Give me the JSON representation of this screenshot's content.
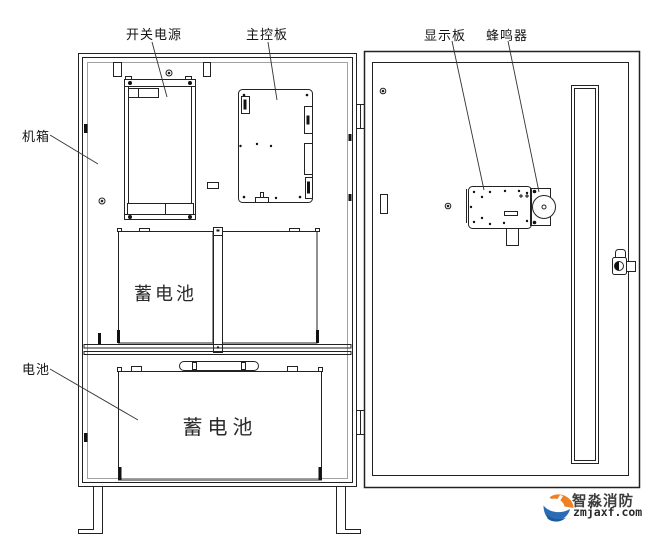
{
  "diagram": {
    "description": "fire-alarm control cabinet internal layout drawing, open door view",
    "callouts": {
      "power_supply": "开关电源",
      "main_board": "主控板",
      "display_board": "显示板",
      "buzzer": "蜂鸣器",
      "chassis": "机箱",
      "battery": "电池"
    },
    "component_labels": {
      "upper_battery": "蓄电池",
      "lower_battery": "蓄电池"
    }
  },
  "logo": {
    "brand": "智淼消防",
    "domain": "zmjaxf.com",
    "colors": {
      "orange": "#ef8122",
      "blue": "#2a6db5",
      "text": "#3d3d3d"
    }
  }
}
